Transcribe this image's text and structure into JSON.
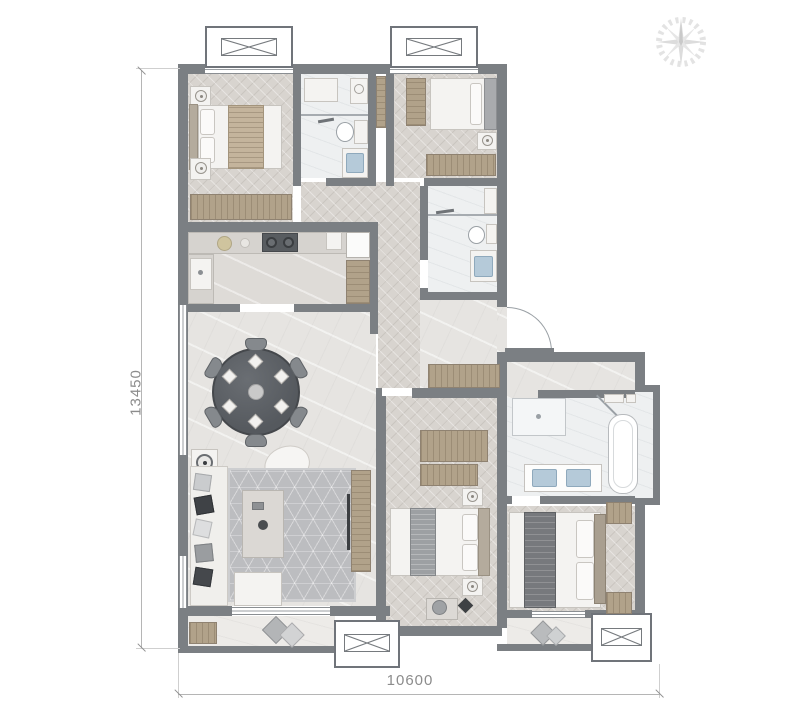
{
  "plan": {
    "kind": "apartment-floor-plan",
    "dimensions": {
      "height_label": "13450",
      "width_label": "10600"
    },
    "compass": {
      "icon": "compass-rose"
    },
    "palette": {
      "wall": "#7b7f83",
      "wood_floor": "#d8d4cf",
      "marble_floor": "#e6e4e1",
      "bath_floor": "#eef0f1",
      "balcony_floor": "#edebe8",
      "wood_furniture": "#b1a28a",
      "dark_table": "#5a5e63",
      "rug": "#bcbdc0",
      "basin_blue": "#b5cad9",
      "dimension_text": "#8c8c8c"
    },
    "rooms": [
      {
        "id": "bedroom-1",
        "furniture": [
          "double-bed",
          "nightstand",
          "nightstand",
          "dresser"
        ]
      },
      {
        "id": "bathroom-1",
        "furniture": [
          "washer",
          "shelf",
          "toilet",
          "vanity-sink",
          "glass-screen"
        ]
      },
      {
        "id": "bedroom-2",
        "furniture": [
          "wardrobe",
          "double-bed",
          "nightstand",
          "bench"
        ]
      },
      {
        "id": "bathroom-2",
        "furniture": [
          "washer",
          "toilet",
          "vanity-sink",
          "glass-screen"
        ]
      },
      {
        "id": "kitchen",
        "furniture": [
          "counter",
          "sink",
          "cooktop",
          "fridge",
          "tall-cabinet"
        ]
      },
      {
        "id": "dining-room",
        "furniture": [
          "round-table",
          "chair-x6",
          "place-setting-x6"
        ]
      },
      {
        "id": "living-room",
        "furniture": [
          "sofa",
          "coffee-table",
          "rug",
          "accent-chair",
          "side-table",
          "tv-console",
          "ottoman"
        ]
      },
      {
        "id": "foyer",
        "furniture": [
          "shoe-cabinet",
          "entry-door"
        ]
      },
      {
        "id": "bedroom-3",
        "furniture": [
          "wardrobe",
          "double-bed",
          "nightstand",
          "nightstand",
          "desk",
          "chair"
        ]
      },
      {
        "id": "master-bathroom",
        "furniture": [
          "shower",
          "bathtub",
          "double-vanity",
          "shelves"
        ]
      },
      {
        "id": "master-bedroom",
        "furniture": [
          "double-bed",
          "nightstand",
          "nightstand",
          "wardrobe"
        ]
      },
      {
        "id": "balcony-south",
        "furniture": [
          "mat",
          "cushions"
        ]
      },
      {
        "id": "balcony-master",
        "furniture": [
          "cushions"
        ]
      }
    ],
    "windows": [
      "bay-window-top-left",
      "bay-window-top-right",
      "bay-window-bottom-center",
      "bay-window-bottom-right"
    ]
  }
}
